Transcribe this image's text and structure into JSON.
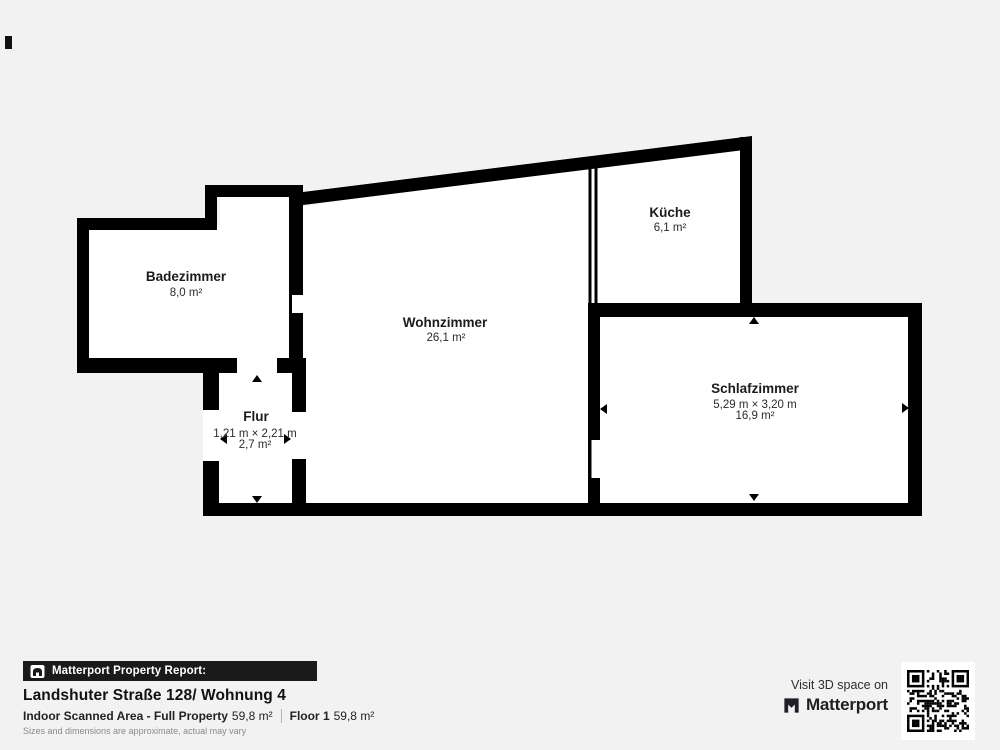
{
  "rooms": {
    "badezimmer": {
      "name": "Badezimmer",
      "area": "8,0 m²"
    },
    "wohnzimmer": {
      "name": "Wohnzimmer",
      "area": "26,1 m²"
    },
    "kueche": {
      "name": "Küche",
      "area": "6,1 m²"
    },
    "schlafzimmer": {
      "name": "Schlafzimmer",
      "dims": "5,29 m × 3,20 m",
      "area": "16,9 m²"
    },
    "flur": {
      "name": "Flur",
      "dims": "1,21 m × 2,21 m",
      "area": "2,7 m²"
    }
  },
  "footer": {
    "report_label": "Matterport Property Report:",
    "title": "Landshuter Straße 128/ Wohnung 4",
    "scanned_area_label": "Indoor Scanned Area - Full Property",
    "scanned_area_value": "59,8 m²",
    "floor_label": "Floor 1",
    "floor_value": "59,8 m²",
    "disclaimer": "Sizes and dimensions are approximate, actual may vary"
  },
  "cta": {
    "visit_label": "Visit 3D space on",
    "brand": "Matterport"
  },
  "colors": {
    "background": "#f2f2f2",
    "wall": "#000000",
    "floor": "#ffffff",
    "banner": "#1a1a1a"
  }
}
